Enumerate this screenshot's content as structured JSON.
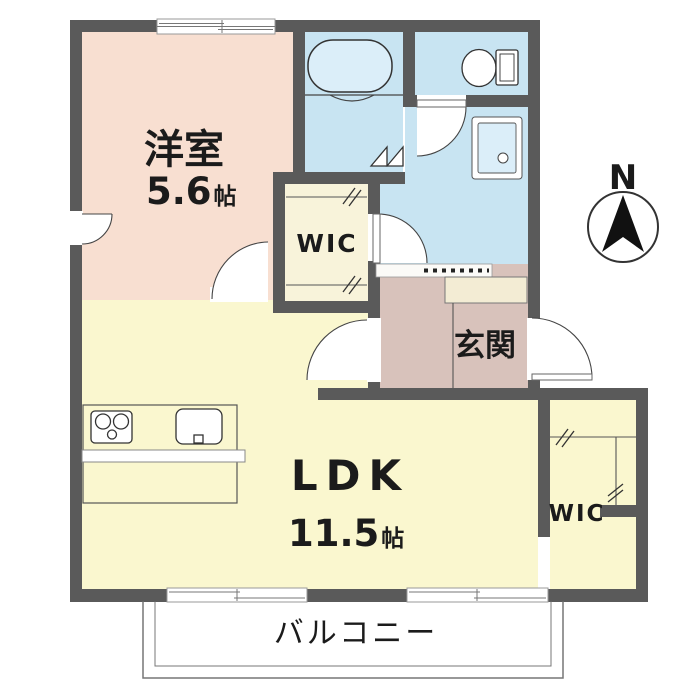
{
  "plan": {
    "title": "1LDK apartment floor plan",
    "compass_label": "N",
    "colors": {
      "wall": "#5a5a5a",
      "western_room": "#f8dfd1",
      "wet_area": "#c8e4f2",
      "wic": "#f8f3da",
      "entrance": "#d8c2bb",
      "shoe_cabinet": "#f3ecd4",
      "ldk": "#faf7cf",
      "tub": "#dbeef9",
      "pan_inner": "#dbeef9"
    },
    "rooms": {
      "western_room": {
        "label": "洋室",
        "size_value": "5.6",
        "size_unit": "帖"
      },
      "wic_upper": {
        "label": "WIC"
      },
      "entrance": {
        "label": "玄関"
      },
      "ldk": {
        "label": "LDK",
        "size_value": "11.5",
        "size_unit": "帖"
      },
      "wic_lower": {
        "label": "WIC"
      },
      "balcony": {
        "label": "バルコニー"
      }
    },
    "fixtures": [
      "bathtub",
      "toilet",
      "laundry-pan",
      "stove",
      "sink",
      "folding-door",
      "sliding-windows"
    ]
  }
}
